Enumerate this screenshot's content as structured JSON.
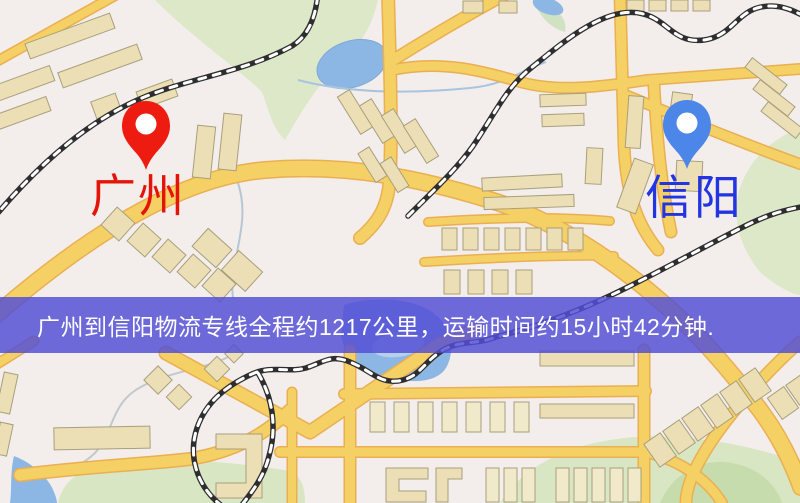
{
  "map": {
    "origin": {
      "label": "广州",
      "pin_color": "#ee1c10"
    },
    "destination": {
      "label": "信阳",
      "pin_color": "#4c86e8"
    },
    "banner": {
      "text": "广州到信阳物流专线全程约1217公里，运输时间约15小时42分钟.",
      "background": "#534fd5",
      "text_color": "#ffffff"
    },
    "colors": {
      "map_background": "#f3eeec",
      "road": "#f5d065",
      "road_casing": "#eaaf52",
      "water": "#8cb6e4",
      "park": "#dce8c8",
      "railway": "#2e2e30",
      "building": "#ecdfb6"
    }
  }
}
